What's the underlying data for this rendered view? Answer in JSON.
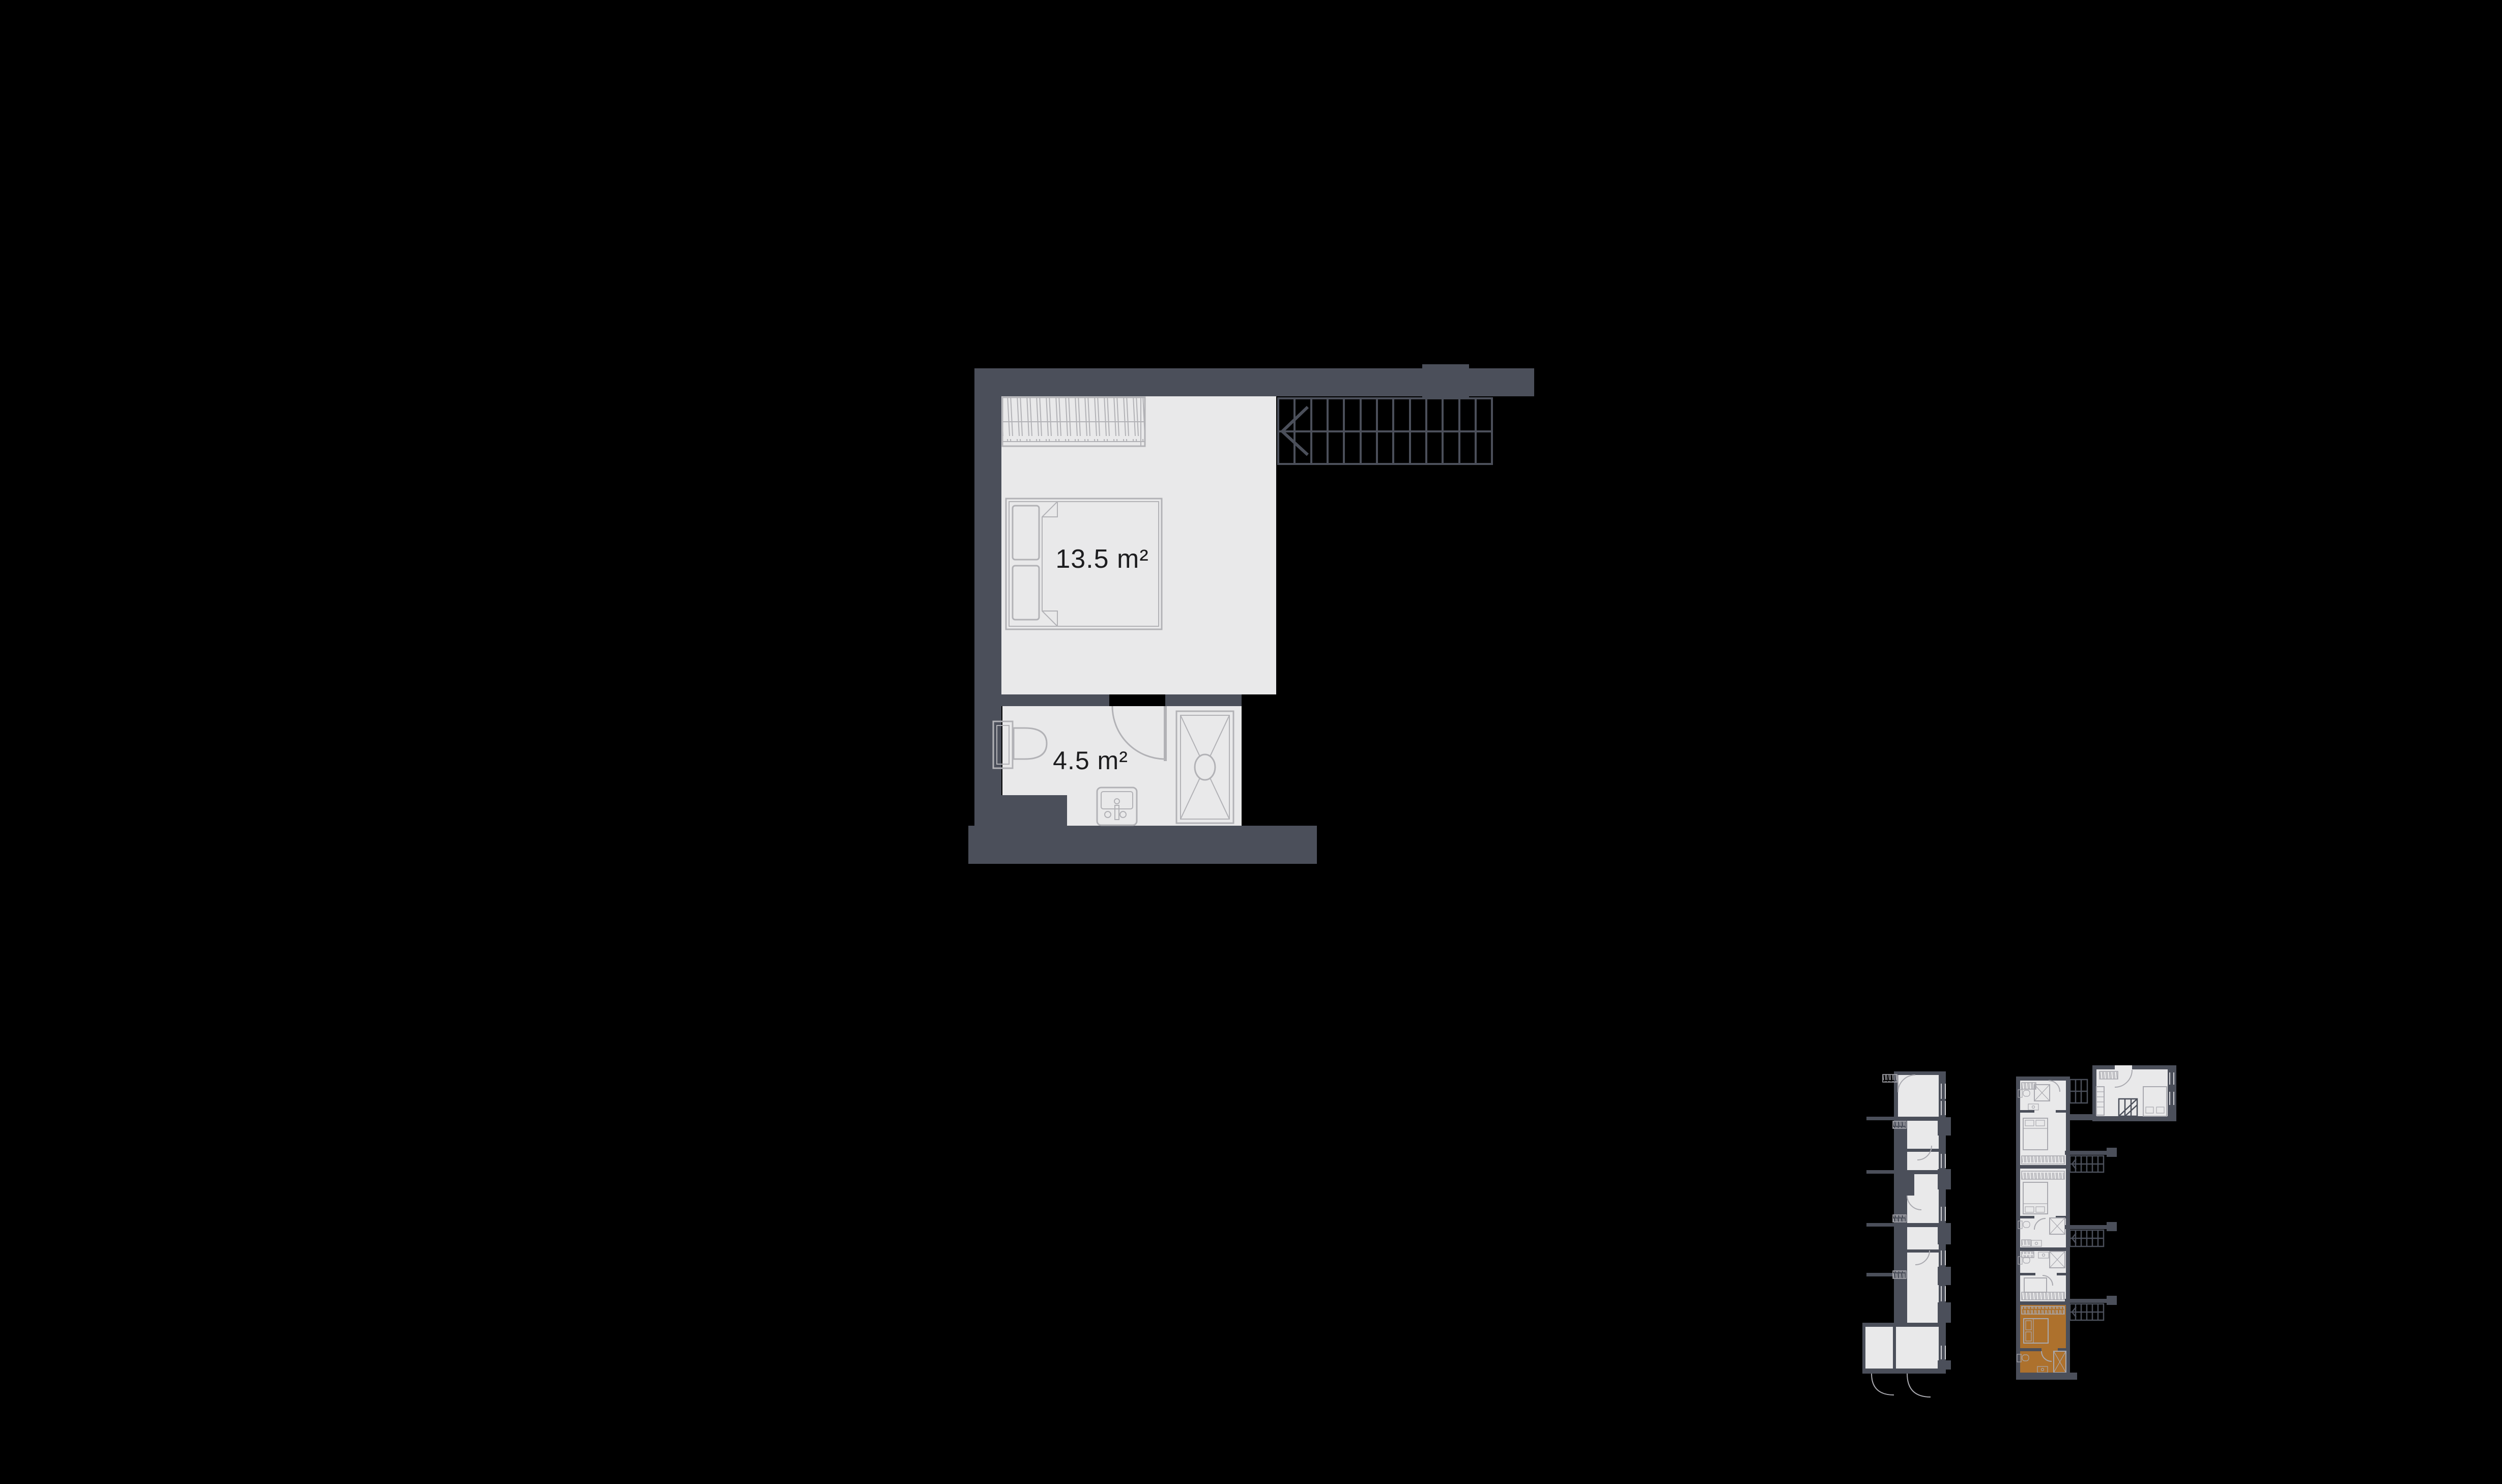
{
  "colors": {
    "background": "#000000",
    "wall": "#4b4f5a",
    "floor": "#e9e9ea",
    "line": "#b2b2b6",
    "stairline": "#4b4f5a",
    "text": "#1d1d1f",
    "highlight": "#ad712d",
    "miniline": "#a9a9af",
    "window": "#d4d4d8"
  },
  "main_plan": {
    "bedroom": {
      "area_label": "13.5 m²"
    },
    "bathroom": {
      "area_label": "4.5 m²"
    }
  },
  "mini_plans": {
    "left_building": {
      "highlighted_unit": null
    },
    "right_building": {
      "highlighted_unit": "bottom-unit"
    }
  }
}
